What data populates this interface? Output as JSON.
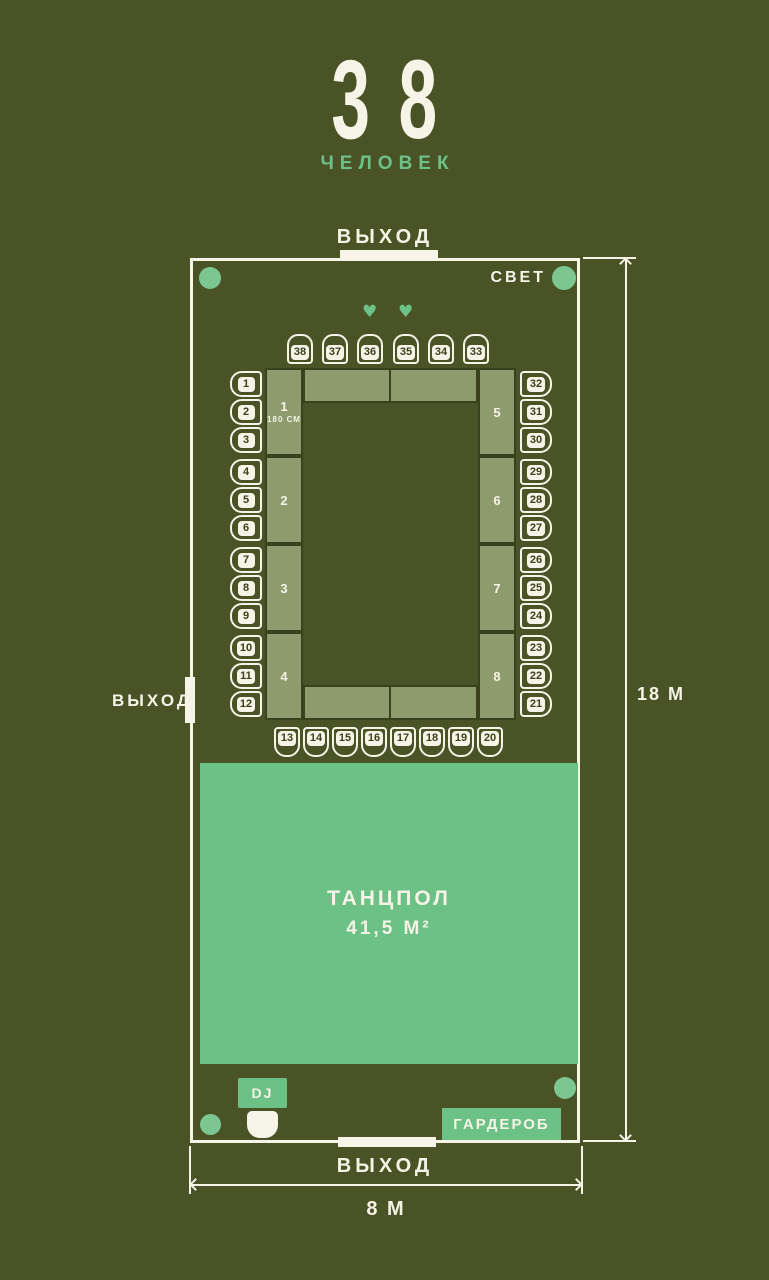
{
  "title": {
    "count": "38",
    "label": "ЧЕЛОВЕК"
  },
  "exits": {
    "top": "ВЫХОД",
    "left": "ВЫХОД",
    "bottom": "ВЫХОД"
  },
  "light": {
    "label": "СВЕТ"
  },
  "dimensions": {
    "height": "18 М",
    "width": "8 М"
  },
  "tables": {
    "left": [
      {
        "number": "1",
        "note": "180 СМ"
      },
      {
        "number": "2"
      },
      {
        "number": "3"
      },
      {
        "number": "4"
      }
    ],
    "right": [
      {
        "number": "5"
      },
      {
        "number": "6"
      },
      {
        "number": "7"
      },
      {
        "number": "8"
      }
    ]
  },
  "chairs": {
    "top": [
      "38",
      "37",
      "36",
      "35",
      "34",
      "33"
    ],
    "bottom": [
      "13",
      "14",
      "15",
      "16",
      "17",
      "18",
      "19",
      "20"
    ],
    "left": [
      "1",
      "2",
      "3",
      "4",
      "5",
      "6",
      "7",
      "8",
      "9",
      "10",
      "11",
      "12"
    ],
    "right": [
      "32",
      "31",
      "30",
      "29",
      "28",
      "27",
      "26",
      "25",
      "24",
      "23",
      "22",
      "21"
    ]
  },
  "hearts_above_chairs": [
    "36",
    "35"
  ],
  "icons": {
    "heart": "♥"
  },
  "dance_floor": {
    "label": "ТАНЦПОЛ",
    "area": "41,5 М²"
  },
  "dj": {
    "label": "DJ"
  },
  "wardrobe": {
    "label": "ГАРДЕРОБ"
  },
  "colors": {
    "background": "#4a5326",
    "wall": "#f6f3e7",
    "accent_green": "#6cc186",
    "light_dot_green": "#7cc791",
    "table_fill": "#8d9b6d",
    "table_border": "#39421b"
  }
}
